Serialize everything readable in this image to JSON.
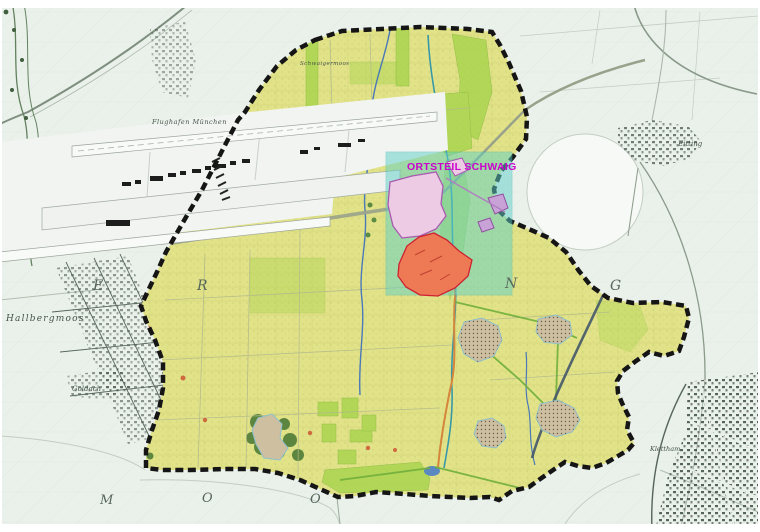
{
  "map": {
    "highlight": {
      "label": "ORTSTEIL SCHWAIG"
    },
    "places": {
      "flughafen": "Flughafen München",
      "schwaigermoos": "Schwaigermoos",
      "hallbergmoos": "Hallbergmoos",
      "goldach": "Goldach",
      "eitting": "Eitting",
      "klettham": "Klettham"
    },
    "district_letters": [
      "E",
      "R",
      "N",
      "G"
    ],
    "moos_letters": [
      "M",
      "O",
      "O"
    ],
    "colors": {
      "paper": "#EAF0EA",
      "municipality": "#E2E388",
      "boundary": "#151515",
      "highlight_cyan": "#5FD0C8",
      "label_magenta": "#CC00CC",
      "settlement_red": "#EE7A55",
      "settlement_pink": "#EDCBE5",
      "settlement_purple": "#C9A2D8",
      "village_tan": "#CDBFA0",
      "field_green": "#A9D44F",
      "forest_green": "#4E7C38",
      "stream_blue": "#4A78B8",
      "road_orange": "#D4863C",
      "highway_dark": "#44566A"
    }
  }
}
